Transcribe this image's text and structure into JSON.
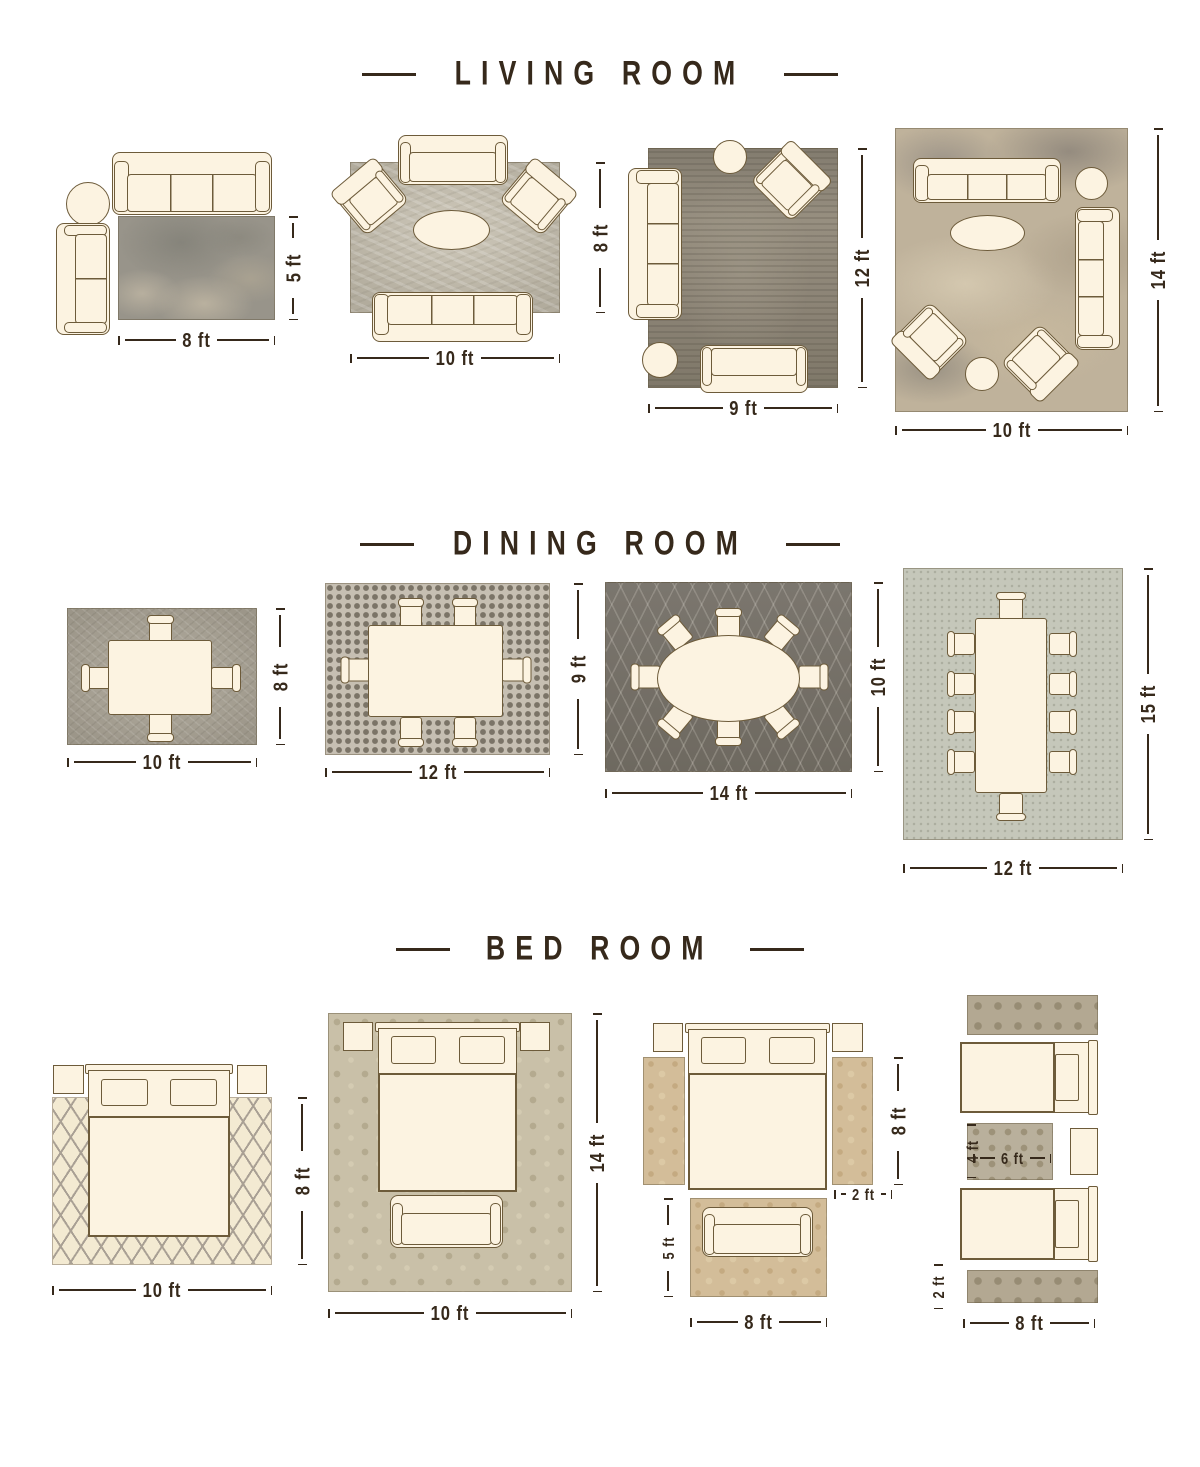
{
  "page": {
    "background": "#ffffff"
  },
  "palette": {
    "title_color": "#36291b",
    "dimension_color": "#36291b",
    "furniture_fill": "#fcf3e1",
    "furniture_outline": "#6d5b3a"
  },
  "sections": [
    {
      "title": "LIVING ROOM",
      "layouts": [
        {
          "name": "living-rug-8x5",
          "labels": {
            "width": "8 ft",
            "height": "5 ft"
          }
        },
        {
          "name": "living-rug-10x8",
          "labels": {
            "width": "10 ft",
            "height": "8 ft"
          }
        },
        {
          "name": "living-rug-9x12",
          "labels": {
            "width": "9 ft",
            "height": "12 ft"
          }
        },
        {
          "name": "living-rug-10x14",
          "labels": {
            "width": "10 ft",
            "height": "14 ft"
          }
        }
      ]
    },
    {
      "title": "DINING ROOM",
      "layouts": [
        {
          "name": "dining-rug-10x8",
          "labels": {
            "width": "10 ft",
            "height": "8 ft"
          }
        },
        {
          "name": "dining-rug-12x9",
          "labels": {
            "width": "12 ft",
            "height": "9 ft"
          }
        },
        {
          "name": "dining-rug-14x10",
          "labels": {
            "width": "14 ft",
            "height": "10 ft"
          }
        },
        {
          "name": "dining-rug-12x15",
          "labels": {
            "width": "12 ft",
            "height": "15 ft"
          }
        }
      ]
    },
    {
      "title": "BED ROOM",
      "layouts": [
        {
          "name": "bed-rug-10x8",
          "labels": {
            "width": "10 ft",
            "height": "8 ft"
          }
        },
        {
          "name": "bed-rug-10x14",
          "labels": {
            "width": "10 ft",
            "height": "14 ft"
          }
        },
        {
          "name": "bed-runners-8x2",
          "labels": {
            "runner_length": "8 ft",
            "runner_width": "2 ft",
            "foot_rug_height": "5 ft",
            "foot_rug_width": "8 ft"
          }
        },
        {
          "name": "bed-twin-runners",
          "labels": {
            "center_rug_height": "4 ft",
            "center_rug_width": "6 ft",
            "runner_height": "2 ft",
            "runner_length": "8 ft"
          }
        }
      ]
    }
  ]
}
